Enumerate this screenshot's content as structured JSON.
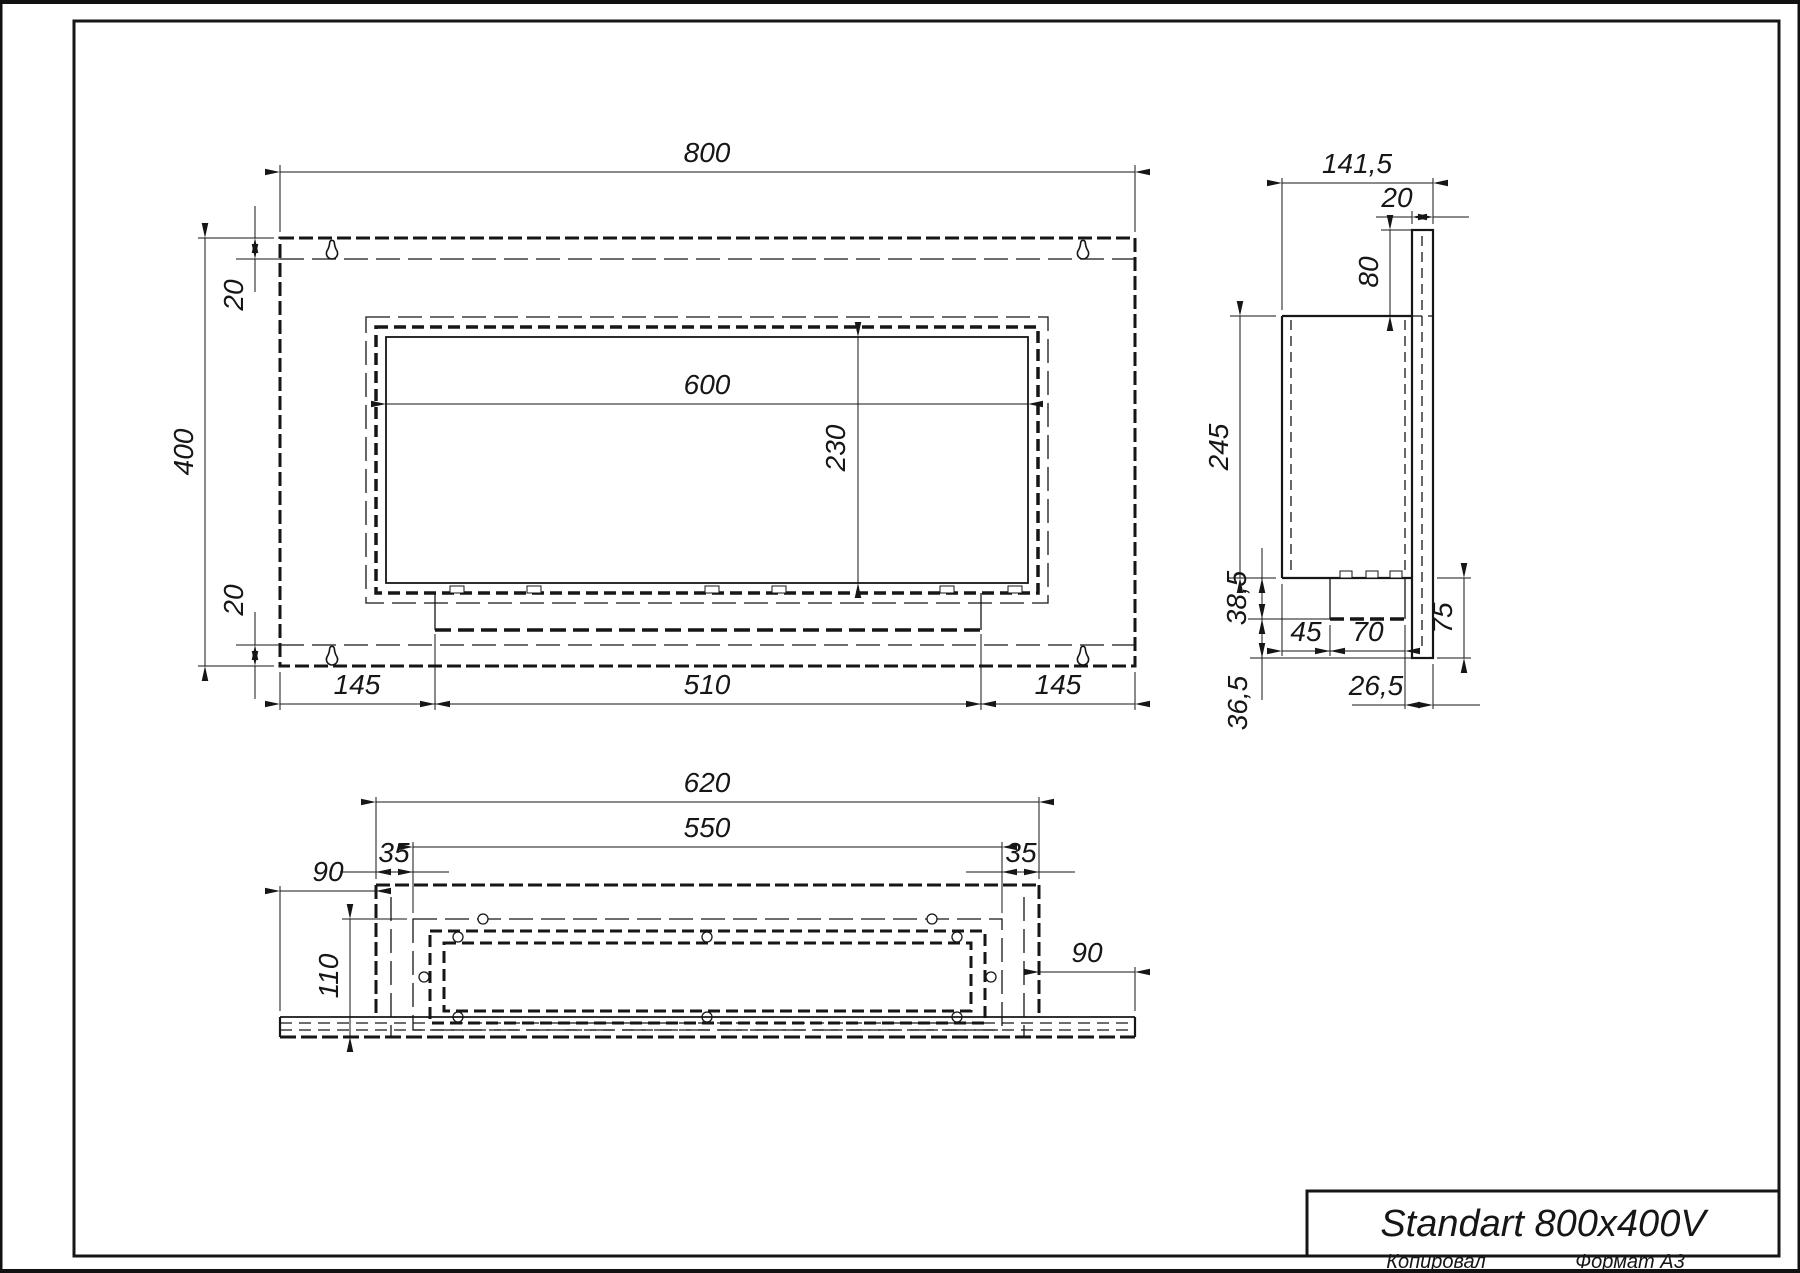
{
  "drawing": {
    "front": {
      "width": "800",
      "height": "400",
      "offset_top": "20",
      "offset_bottom": "20",
      "opening_width": "600",
      "opening_height": "230",
      "margin_left": "145",
      "drawer_width": "510",
      "margin_right": "145"
    },
    "side": {
      "depth": "141,5",
      "panel_thickness": "20",
      "top_gap": "80",
      "body_height": "245",
      "ledge_height": "38,5",
      "burner_inset": "45",
      "burner_width": "70",
      "bottom_gap": "36,5",
      "back_inset": "26,5",
      "lower_height": "75"
    },
    "bottom": {
      "outer_width": "620",
      "inner_width": "550",
      "margin_left": "35",
      "margin_right": "35",
      "overhang_left": "90",
      "overhang_right": "90",
      "depth": "110"
    },
    "title_block": {
      "title": "Standart 800x400V",
      "copied": "Копировал",
      "format": "Формат А3"
    }
  }
}
